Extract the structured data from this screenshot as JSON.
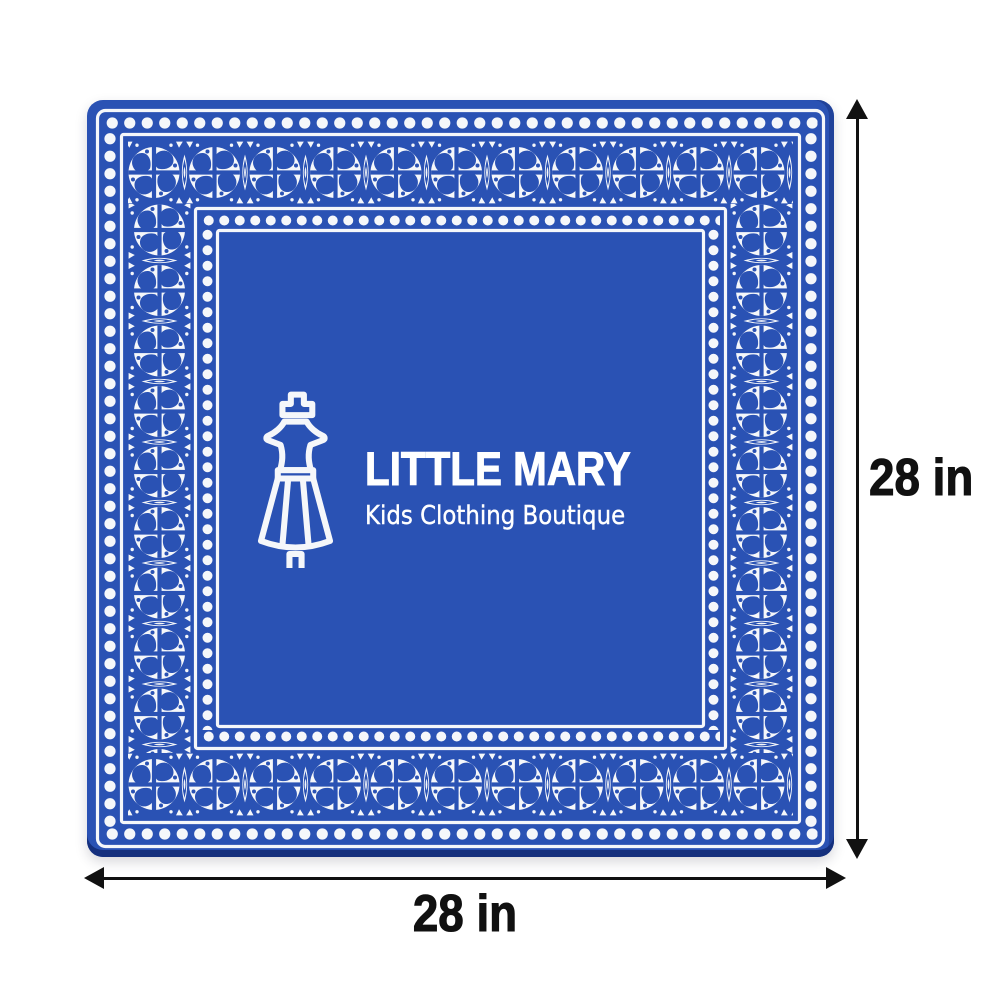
{
  "page": {
    "background_color": "#ffffff"
  },
  "bandana": {
    "shape": "square",
    "fabric_color": "#2a52b4",
    "pattern_color": "#f5f7fa",
    "edge_shade_color": "#142e7a",
    "border": {
      "motifs": [
        "dot-row",
        "frame-line",
        "circle-medallion",
        "teardrop",
        "marquise-leaf",
        "triangle-notch"
      ]
    },
    "logo": {
      "icon": "dress-form-icon",
      "brand_name": "LITTLE MARY",
      "tagline": "Kids Clothing Boutique",
      "text_color": "#ffffff"
    }
  },
  "dimensions": {
    "arrow_color": "#111111",
    "label_color": "#111111",
    "width": {
      "label": "28 in"
    },
    "height": {
      "label": "28 in"
    }
  }
}
